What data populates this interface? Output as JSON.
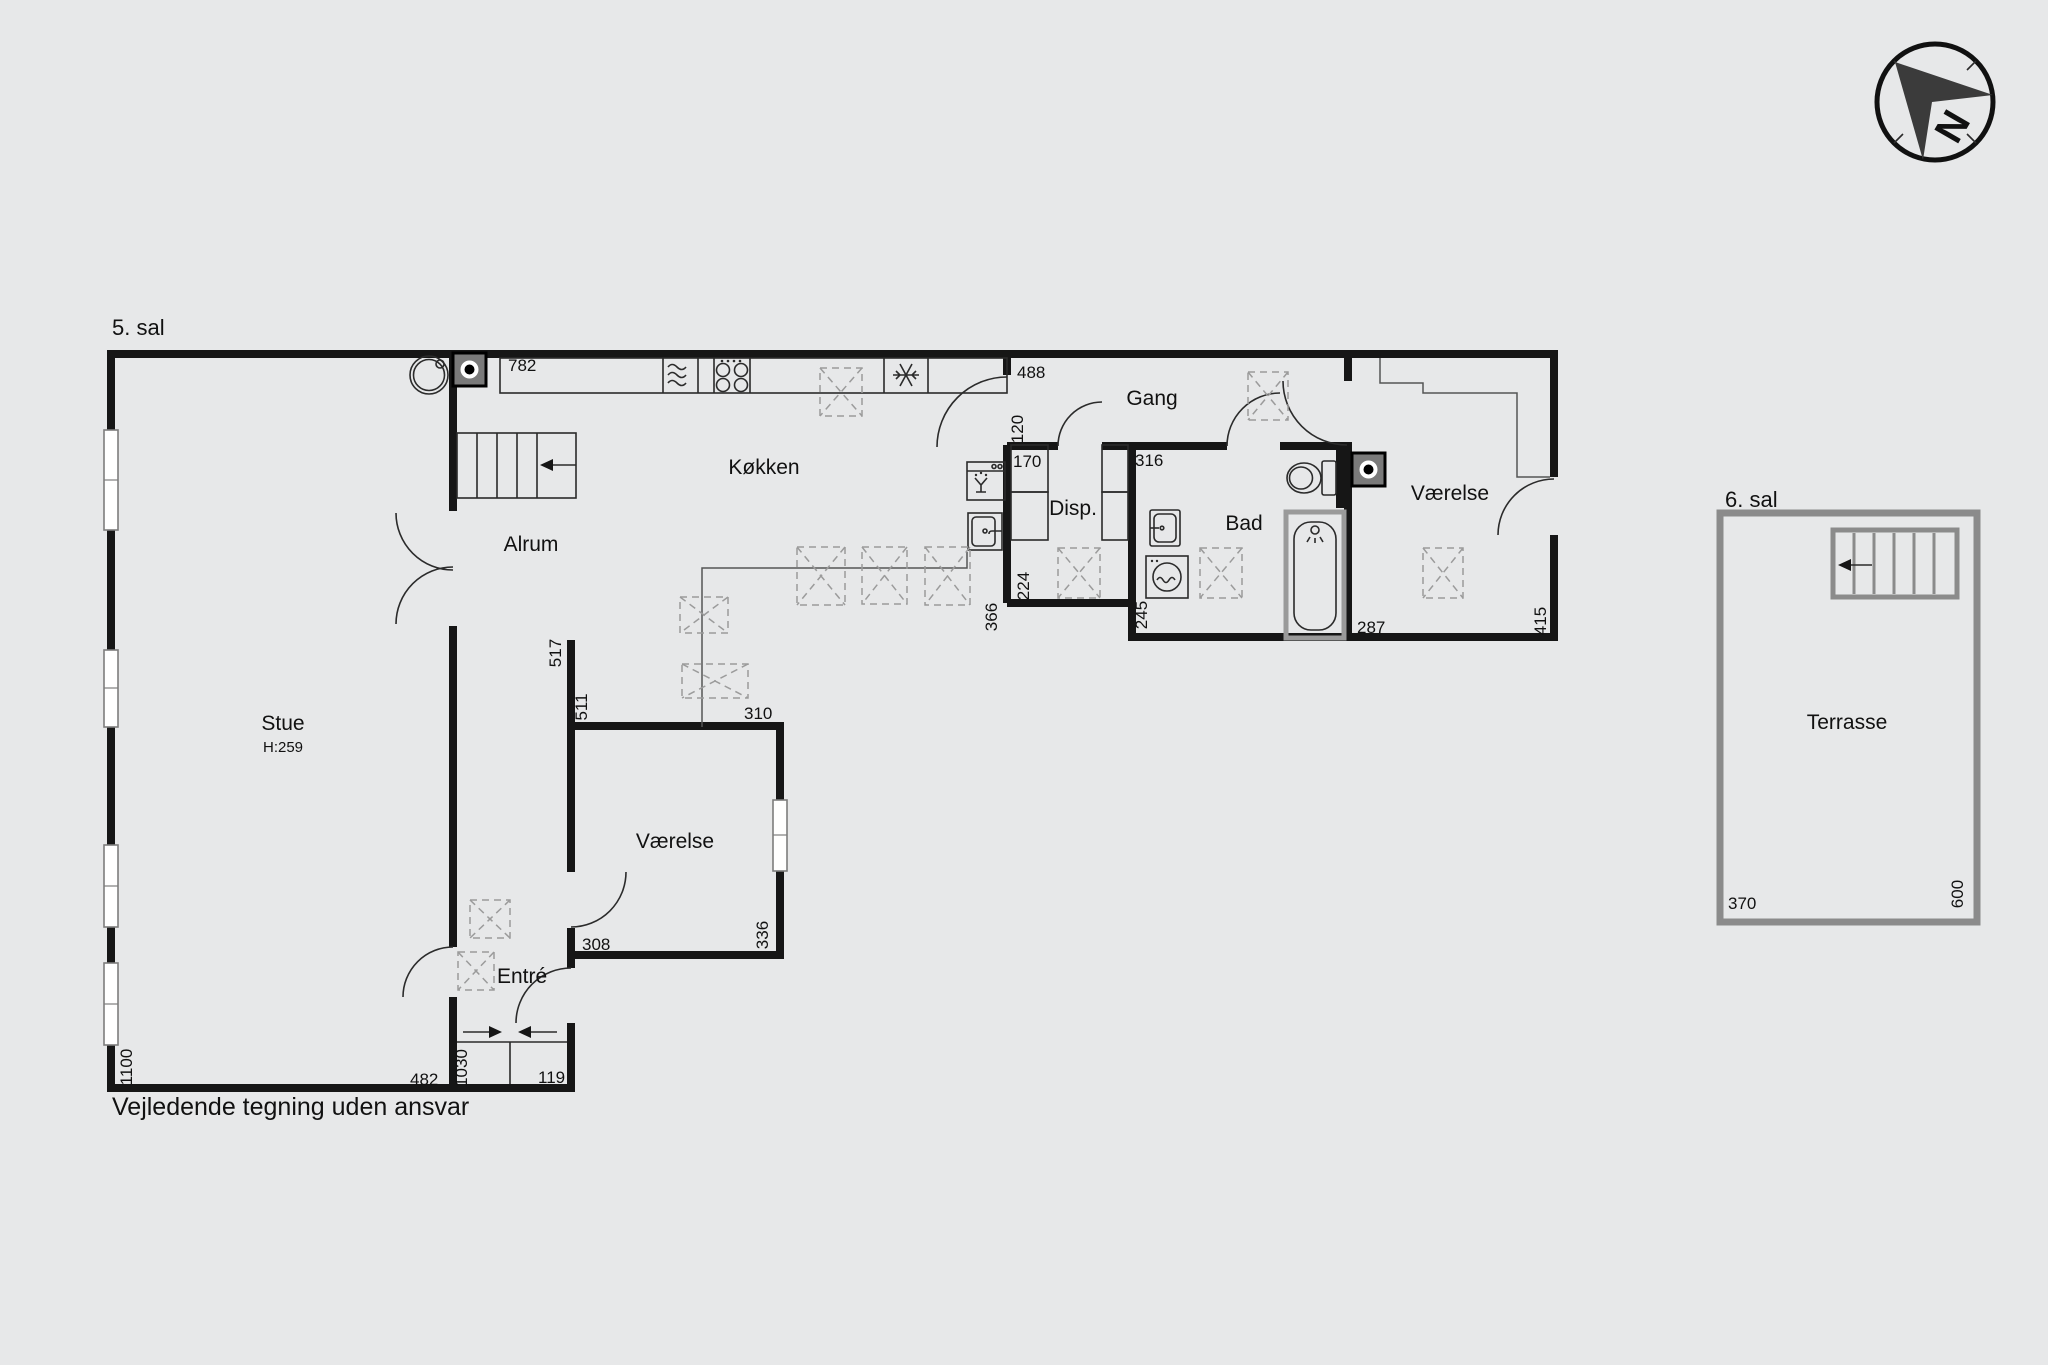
{
  "floor5": {
    "title": "5. sal",
    "rooms": {
      "stue": {
        "name": "Stue",
        "ceiling_height": "H:259"
      },
      "alrum": {
        "name": "Alrum"
      },
      "kokken": {
        "name": "Køkken"
      },
      "gang": {
        "name": "Gang"
      },
      "disp": {
        "name": "Disp."
      },
      "bad": {
        "name": "Bad"
      },
      "vaerelse_east": {
        "name": "Værelse"
      },
      "vaerelse_south": {
        "name": "Værelse"
      },
      "entre": {
        "name": "Entré"
      }
    },
    "dimensions": {
      "kitchen_counter": "782",
      "gang_width": "488",
      "kitchen_door": "120",
      "disp_closet": "170",
      "bad_width": "316",
      "kokken_right_wall": "366",
      "disp_depth": "224",
      "bad_left_wall": "245",
      "bad_tub_wall": "287",
      "vaerelse_east_depth": "415",
      "hall_wall_upper": "517",
      "vaerelse_south_top": "511",
      "vaerelse_south_width": "310",
      "vaerelse_south_bottom": "308",
      "vaerelse_south_depth": "336",
      "stue_bottom": "482",
      "stue_left_wall": "1100",
      "entre_length": "1030",
      "entre_width": "119"
    }
  },
  "floor6": {
    "title": "6. sal",
    "rooms": {
      "terrasse": {
        "name": "Terrasse"
      }
    },
    "dimensions": {
      "width": "370",
      "depth": "600"
    }
  },
  "compass": {
    "north_label": "N"
  },
  "footer": {
    "disclaimer": "Vejledende tegning uden ansvar"
  },
  "colors": {
    "background": "#e7e8e9",
    "wall": "#161616",
    "thin_line": "#2b2b2b",
    "dashed_furniture": "#9b9b9b",
    "terrace_grey": "#8b8b8b"
  }
}
